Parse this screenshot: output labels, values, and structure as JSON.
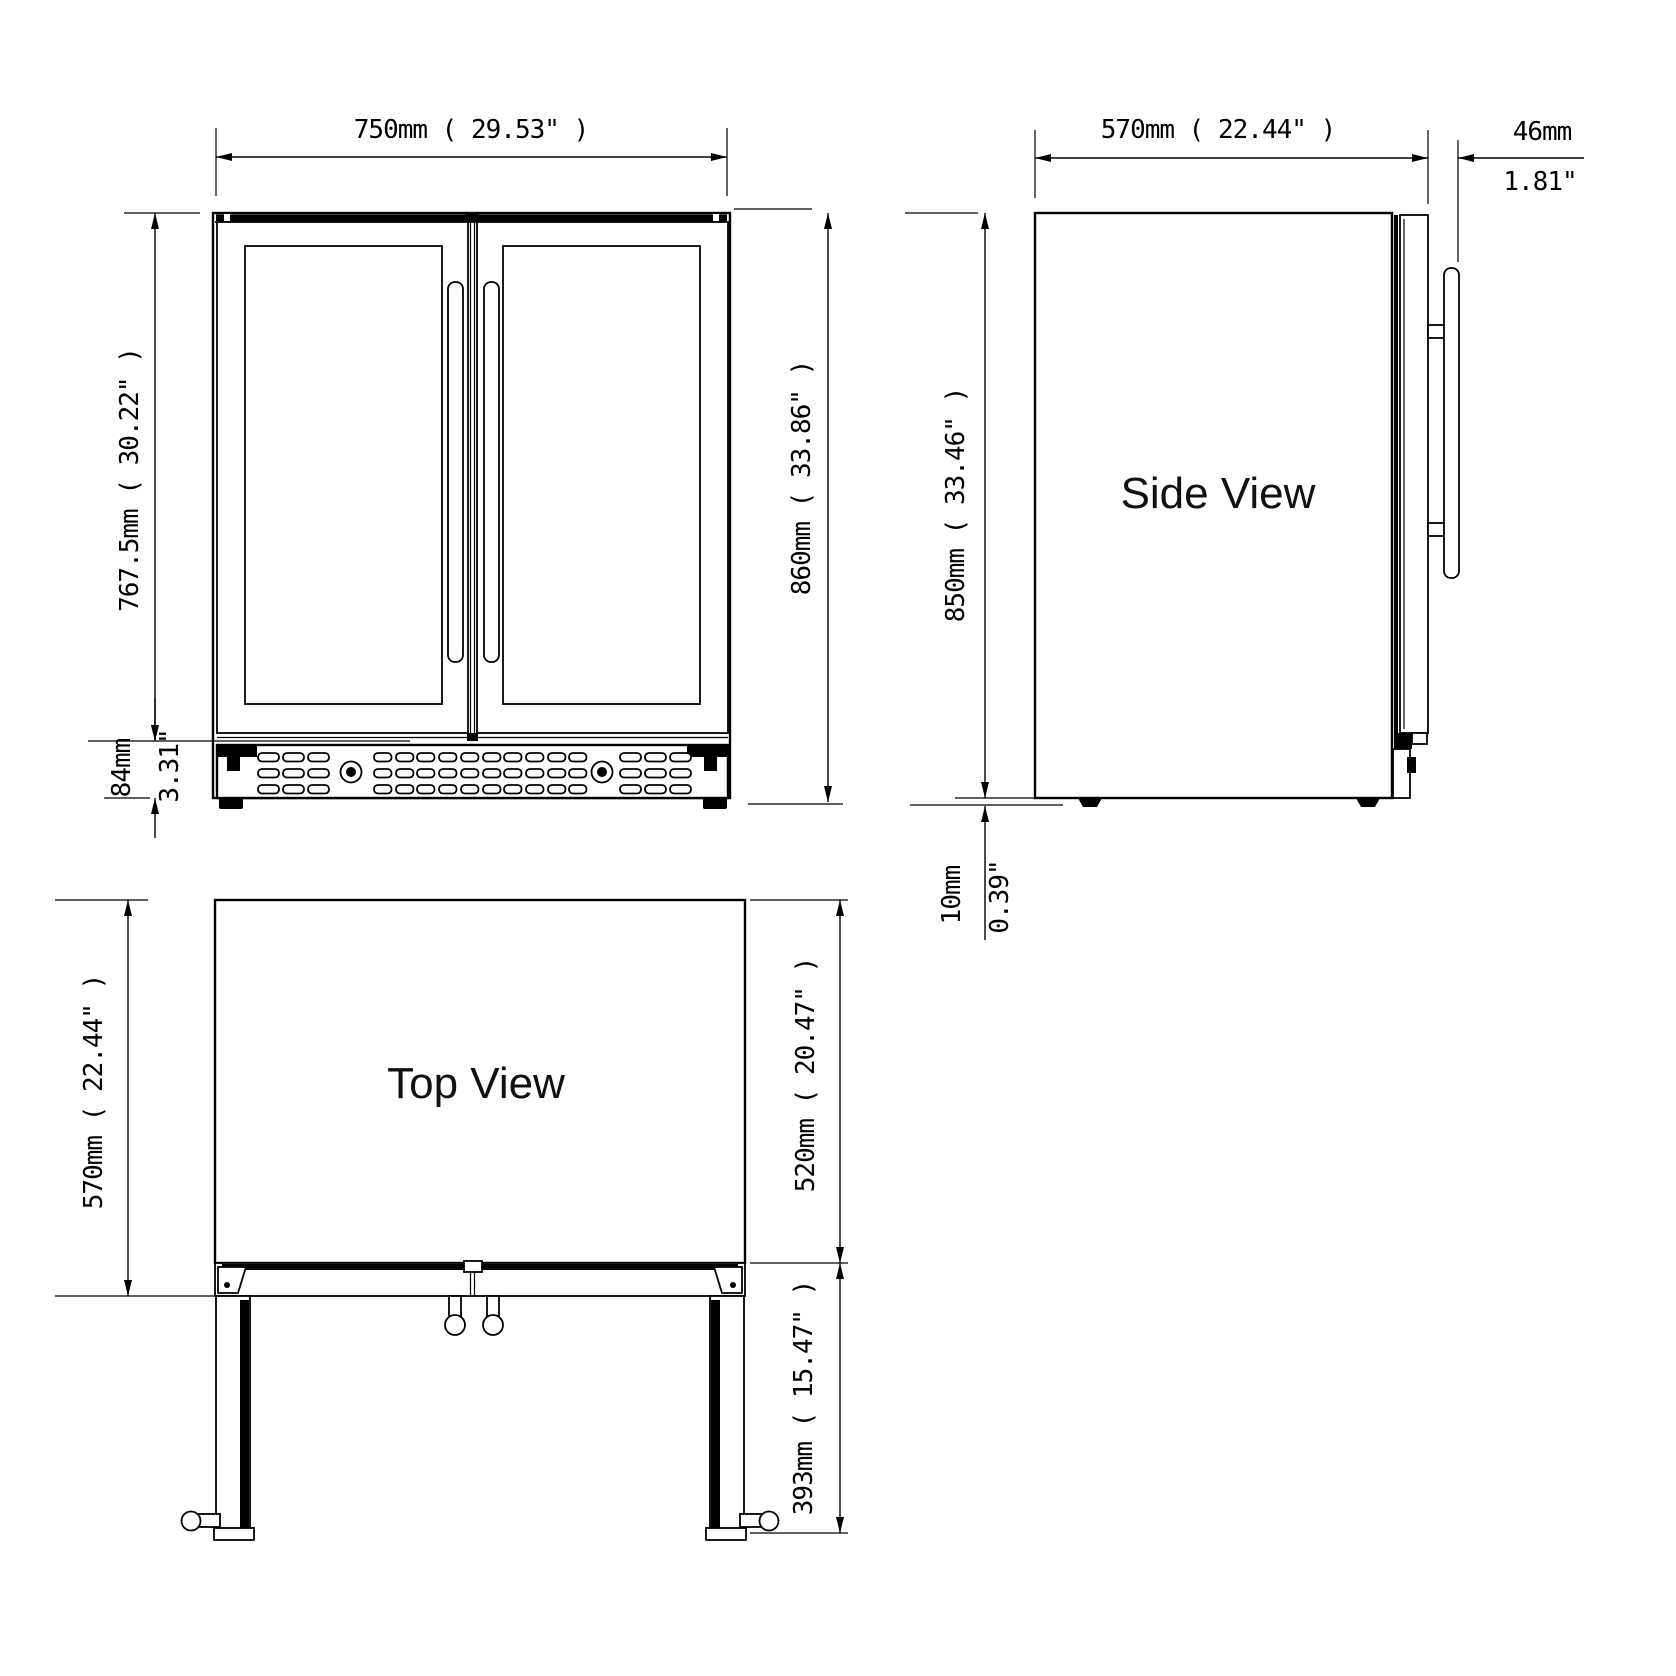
{
  "drawing_title": "Beverage cooler dimension drawing",
  "front_view": {
    "width_dim": "750mm ( 29.53\" )",
    "door_height_dim": "767.5mm ( 30.22\" )",
    "vent_height_mm": "84mm",
    "vent_height_in": "3.31\"",
    "total_height_dim": "860mm ( 33.86\" )"
  },
  "side_view": {
    "label": "Side View",
    "depth_dim": "570mm ( 22.44\" )",
    "handle_depth_mm": "46mm",
    "handle_depth_in": "1.81\"",
    "body_height_dim": "850mm ( 33.46\" )",
    "foot_height_mm": "10mm",
    "foot_height_in": "0.39\""
  },
  "top_view": {
    "label": "Top View",
    "depth_dim": "570mm ( 22.44\" )",
    "body_depth_dim": "520mm ( 20.47\" )",
    "door_swing_dim": "393mm ( 15.47\" )"
  },
  "colors": {
    "line": "#000000",
    "background": "#ffffff"
  }
}
